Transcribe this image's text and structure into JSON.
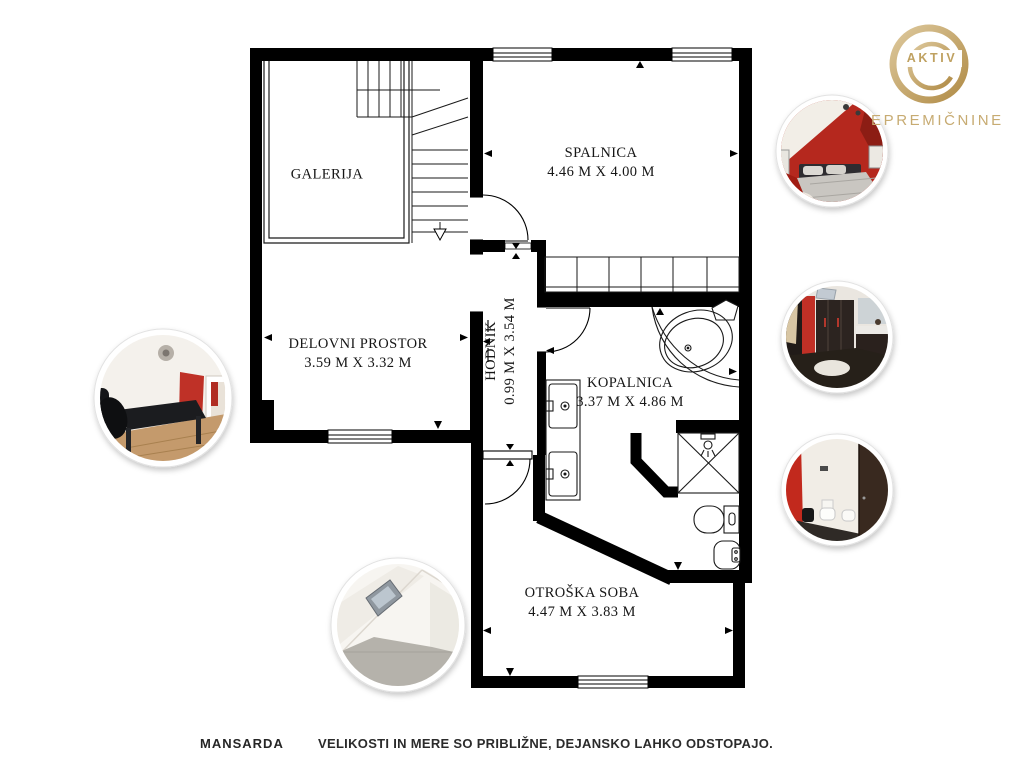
{
  "logo": {
    "brand": "AKTIV",
    "company": "EPREMIČNINE",
    "gold": "#c3a467"
  },
  "rooms": {
    "galerija": {
      "name": "GALERIJA",
      "dims": ""
    },
    "spalnica": {
      "name": "SPALNICA",
      "dims": "4.46 M X 4.00 M"
    },
    "delovni": {
      "name": "DELOVNI PROSTOR",
      "dims": "3.59 M X 3.32 M"
    },
    "hodnik": {
      "name": "HODNIK",
      "dims": "0.99 M X 3.54 M"
    },
    "kopalnica": {
      "name": "KOPALNICA",
      "dims": "3.37 M X 4.86 M"
    },
    "otroska": {
      "name": "OTROŠKA SOBA",
      "dims": "4.47 M X 3.83 M"
    }
  },
  "footer": {
    "floor_name": "MANSARDA",
    "disclaimer": "VELIKOSTI IN MERE SO PRIBLIŽNE, DEJANSKO LAHKO ODSTOPAJO."
  },
  "colors": {
    "wall": "#000000",
    "accent_red": "#c23127",
    "photo_ring": "#ffffff"
  },
  "photos": [
    {
      "id": "office-photo"
    },
    {
      "id": "attic-room-photo"
    },
    {
      "id": "bedroom-photo"
    },
    {
      "id": "bathroom-photo"
    },
    {
      "id": "wc-photo"
    }
  ]
}
